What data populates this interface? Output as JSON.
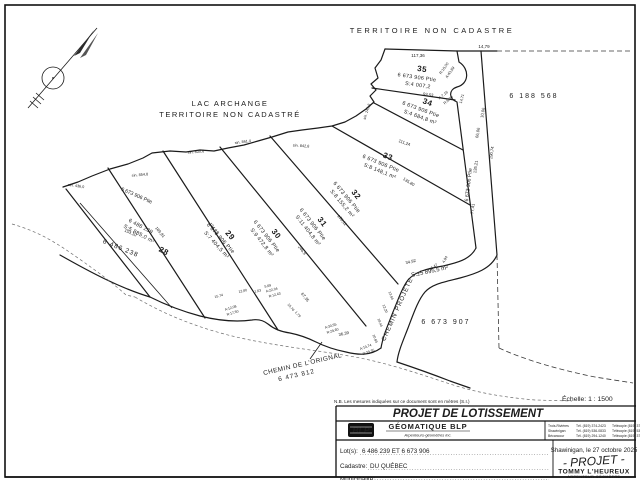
{
  "map": {
    "territoire_top": "TERRITOIRE NON CADASTRE",
    "lake_line1": "LAC ARCHANGE",
    "lake_line2": "TERRITOIRE NON CADASTRÉ",
    "lots": [
      {
        "num": "35",
        "parcel": "6 673 906 Ptie",
        "area": "S:4 007,2",
        "x": 417,
        "y": 77,
        "r": 8
      },
      {
        "num": "34",
        "parcel": "6 673 906 Ptie",
        "area": "S:4 684,8 m²",
        "x": 421,
        "y": 109,
        "r": 20
      },
      {
        "num": "33",
        "parcel": "6 673 906 Ptie",
        "area": "S:8 148,1 m²",
        "x": 381,
        "y": 163,
        "r": 22
      },
      {
        "num": "32",
        "parcel": "6 673 906 Ptie",
        "area": "S:8 155,2 m²",
        "x": 347,
        "y": 197,
        "r": 50
      },
      {
        "num": "31",
        "parcel": "6 673 906 Ptie",
        "area": "S:11 404,8 m²",
        "x": 313,
        "y": 224,
        "r": 52
      },
      {
        "num": "30",
        "parcel": "6 673 906 Ptie",
        "area": "S:9 472,8 m²",
        "x": 267,
        "y": 236,
        "r": 52
      },
      {
        "num": "29",
        "parcel": "6 673 906 Ptie",
        "area": "S:7 404,5 m²",
        "x": 221,
        "y": 238,
        "r": 48
      },
      {
        "num": "28",
        "parcel": "6 486 239",
        "area": "S:5 885,0 m²",
        "x": 141,
        "y": 226,
        "r": 28,
        "numDx": 32,
        "numDy": 14
      }
    ],
    "labels": [
      {
        "n": "measure",
        "t": "117,36",
        "x": 418,
        "y": 57,
        "r": 0,
        "s": 4.5
      },
      {
        "n": "measure",
        "t": "14,79",
        "x": 484,
        "y": 48,
        "r": 0,
        "s": 4.5
      },
      {
        "n": "curve-measure",
        "t": "R:15,00",
        "x": 445,
        "y": 69,
        "r": -55,
        "s": 3.8
      },
      {
        "n": "curve-measure",
        "t": "A:43,89",
        "x": 451,
        "y": 73,
        "r": -55,
        "s": 3.8
      },
      {
        "n": "curve-measure",
        "t": "A:7,16",
        "x": 444,
        "y": 96,
        "r": -40,
        "s": 3.8
      },
      {
        "n": "curve-measure",
        "t": "R:6,00",
        "x": 449,
        "y": 101,
        "r": -40,
        "s": 3.8
      },
      {
        "n": "measure",
        "t": "14,71",
        "x": 463,
        "y": 99,
        "r": -75,
        "s": 3.8
      },
      {
        "n": "measure",
        "t": "93,53",
        "x": 428,
        "y": 96,
        "r": 8,
        "s": 4.2
      },
      {
        "n": "measure",
        "t": "10,06",
        "x": 484,
        "y": 113,
        "r": -80,
        "s": 4.2
      },
      {
        "n": "measure",
        "t": "111,24",
        "x": 404,
        "y": 144,
        "r": 20,
        "s": 4.2
      },
      {
        "n": "measure",
        "t": "66,06",
        "x": 479,
        "y": 133,
        "r": -80,
        "s": 4.2
      },
      {
        "n": "measure",
        "t": "190,74",
        "x": 493,
        "y": 153,
        "r": -82,
        "s": 4.2
      },
      {
        "n": "measure",
        "t": "135,21",
        "x": 477,
        "y": 167,
        "r": -82,
        "s": 4.2
      },
      {
        "n": "measure",
        "t": "77,41",
        "x": 474,
        "y": 209,
        "r": -82,
        "s": 4.2
      },
      {
        "n": "measure",
        "t": "135,80",
        "x": 408,
        "y": 183,
        "r": 32,
        "s": 4.2
      },
      {
        "n": "measure",
        "t": "178,11",
        "x": 341,
        "y": 221,
        "r": 50,
        "s": 4.2
      },
      {
        "n": "measure",
        "t": "246,9",
        "x": 301,
        "y": 251,
        "r": 52,
        "s": 4.2
      },
      {
        "n": "measure",
        "t": "194,13",
        "x": 213,
        "y": 229,
        "r": 52,
        "s": 4.2
      },
      {
        "n": "measure",
        "t": "169,81",
        "x": 159,
        "y": 233,
        "r": 50,
        "s": 4.2
      },
      {
        "n": "measure",
        "t": "153,10",
        "x": 130,
        "y": 234,
        "r": 24,
        "s": 4.2
      },
      {
        "n": "sinuosity",
        "t": "sin. 436,0",
        "x": 76,
        "y": 187,
        "r": 8,
        "s": 3.8
      },
      {
        "n": "sinuosity",
        "t": "sin. 854,8",
        "x": 140,
        "y": 176,
        "r": -5,
        "s": 3.8
      },
      {
        "n": "sinuosity",
        "t": "sin. 830,6",
        "x": 196,
        "y": 153,
        "r": -5,
        "s": 3.8
      },
      {
        "n": "sinuosity",
        "t": "sin. 861,4",
        "x": 243,
        "y": 143,
        "r": -8,
        "s": 3.8
      },
      {
        "n": "sinuosity",
        "t": "sin. 842,8",
        "x": 301,
        "y": 147,
        "r": 4,
        "s": 3.8
      },
      {
        "n": "sinuosity",
        "t": "sin. 243,6",
        "x": 368,
        "y": 112,
        "r": -72,
        "s": 3.8
      },
      {
        "n": "measure",
        "t": "34,92",
        "x": 411,
        "y": 263,
        "r": -14,
        "s": 4.2
      },
      {
        "n": "measure",
        "t": "16,47",
        "x": 434,
        "y": 268,
        "r": -35,
        "s": 3.8
      },
      {
        "n": "measure",
        "t": "4,94",
        "x": 446,
        "y": 260,
        "r": -62,
        "s": 3.8
      },
      {
        "n": "measure",
        "t": "36,39",
        "x": 344,
        "y": 335,
        "r": -12,
        "s": 4.2
      },
      {
        "n": "measure",
        "t": "67,35",
        "x": 304,
        "y": 298,
        "r": 52,
        "s": 4.2
      },
      {
        "n": "curve-measure",
        "t": "A:30,55",
        "x": 331,
        "y": 327,
        "r": -18,
        "s": 3.5
      },
      {
        "n": "curve-measure",
        "t": "R:29,60",
        "x": 333,
        "y": 332,
        "r": -18,
        "s": 3.5
      },
      {
        "n": "curve-measure",
        "t": "A:22,04",
        "x": 272,
        "y": 291,
        "r": -15,
        "s": 3.5
      },
      {
        "n": "curve-measure",
        "t": "R:12,43",
        "x": 275,
        "y": 296,
        "r": -15,
        "s": 3.5
      },
      {
        "n": "curve-measure",
        "t": "A:12,08",
        "x": 231,
        "y": 309,
        "r": -18,
        "s": 3.5
      },
      {
        "n": "curve-measure",
        "t": "R:17,50",
        "x": 233,
        "y": 314,
        "r": -18,
        "s": 3.5
      },
      {
        "n": "measure",
        "t": "15,74",
        "x": 219,
        "y": 297,
        "r": -15,
        "s": 3.5
      },
      {
        "n": "measure",
        "t": "12,80",
        "x": 243,
        "y": 292,
        "r": -12,
        "s": 3.5
      },
      {
        "n": "measure",
        "t": "1,63",
        "x": 258,
        "y": 292,
        "r": -12,
        "s": 3.5
      },
      {
        "n": "measure",
        "t": "5,69",
        "x": 268,
        "y": 287,
        "r": -10,
        "s": 3.5
      },
      {
        "n": "measure",
        "t": "15,76",
        "x": 290,
        "y": 308,
        "r": 50,
        "s": 3.5
      },
      {
        "n": "measure",
        "t": "1,79",
        "x": 297,
        "y": 315,
        "r": 50,
        "s": 3.5
      },
      {
        "n": "measure",
        "t": "10,69",
        "x": 374,
        "y": 339,
        "r": 68,
        "s": 3.5
      },
      {
        "n": "measure",
        "t": "18,44",
        "x": 379,
        "y": 323,
        "r": 68,
        "s": 3.5
      },
      {
        "n": "measure",
        "t": "12,20",
        "x": 384,
        "y": 309,
        "r": 68,
        "s": 3.5
      },
      {
        "n": "measure",
        "t": "13,94",
        "x": 390,
        "y": 296,
        "r": 68,
        "s": 3.5
      },
      {
        "n": "curve-measure",
        "t": "A:19,74",
        "x": 366,
        "y": 348,
        "r": -20,
        "s": 3.5
      },
      {
        "n": "curve-measure",
        "t": "R:39,35",
        "x": 369,
        "y": 353,
        "r": -20,
        "s": 3.5
      },
      {
        "n": "road-area",
        "t": "S:±5 895,5 m²",
        "x": 430,
        "y": 273,
        "r": -12,
        "s": 6
      },
      {
        "n": "parcel-number",
        "t": "6 188 568",
        "x": 534,
        "y": 98,
        "r": 0,
        "s": 7,
        "ls": 2
      },
      {
        "n": "parcel-number",
        "t": "6 673 907",
        "x": 446,
        "y": 324,
        "r": 0,
        "s": 7,
        "ls": 2
      },
      {
        "n": "parcel-number",
        "t": "6 486 238",
        "x": 120,
        "y": 250,
        "r": 22,
        "s": 6.5,
        "ls": 1
      },
      {
        "n": "parcel-number",
        "t": "6 673 906 Ptie",
        "x": 136,
        "y": 197,
        "r": 24,
        "s": 5.2
      },
      {
        "n": "parcel-number",
        "t": "6 673 906 Ptie",
        "x": 470,
        "y": 185,
        "r": -83,
        "s": 5.2
      },
      {
        "n": "road-name",
        "t": "CHEMIN PROJETE",
        "x": 399,
        "y": 310,
        "r": -66,
        "s": 6.2,
        "ls": 1
      },
      {
        "n": "road-name",
        "t": "CHEMIN DE L'ORIGNAL",
        "x": 303,
        "y": 366,
        "r": -13,
        "s": 6.4,
        "ls": 0.5
      },
      {
        "n": "road-number",
        "t": "6 473 812",
        "x": 297,
        "y": 377,
        "r": -13,
        "s": 6.4,
        "ls": 1
      }
    ]
  },
  "note": "N.B. Les mesures indiquées sur ce document sont en mètres (S.I.)",
  "scale": "Échelle: 1 : 1500",
  "title_block": {
    "title": "PROJET DE LOTISSEMENT",
    "firm": {
      "logo": "BLP",
      "name": "GÉOMATIQUE BLP",
      "subtitle": "Arpenteurs-géomètres inc."
    },
    "offices": [
      {
        "city": "Trois-Rivières",
        "tel": "Tél. (819) 374-2423",
        "fax": "Télécopie (819) 374-0753"
      },
      {
        "city": "Shawinigan",
        "tel": "Tél. (819) 536-0833",
        "fax": "Télécopie (819) 536-0834"
      },
      {
        "city": "Bécancour",
        "tel": "Tél. (819) 294-1240",
        "fax": "Télécopie (819) 374-0753"
      }
    ],
    "lots_label": "Lot(s):",
    "lots_value": "6 486 239 ET 6 673 906",
    "cadastre_label": "Cadastre:",
    "cadastre_value": "DU QUÉBEC",
    "place_date": "Shawinigan, le 27 octobre 2025",
    "stamp": "- PROJET -",
    "surveyor_name": "TOMMY L'HEUREUX",
    "surveyor_title": "ARPENTEUR-GÉOMÈTRE",
    "municipality_label": "Municipalité:"
  }
}
